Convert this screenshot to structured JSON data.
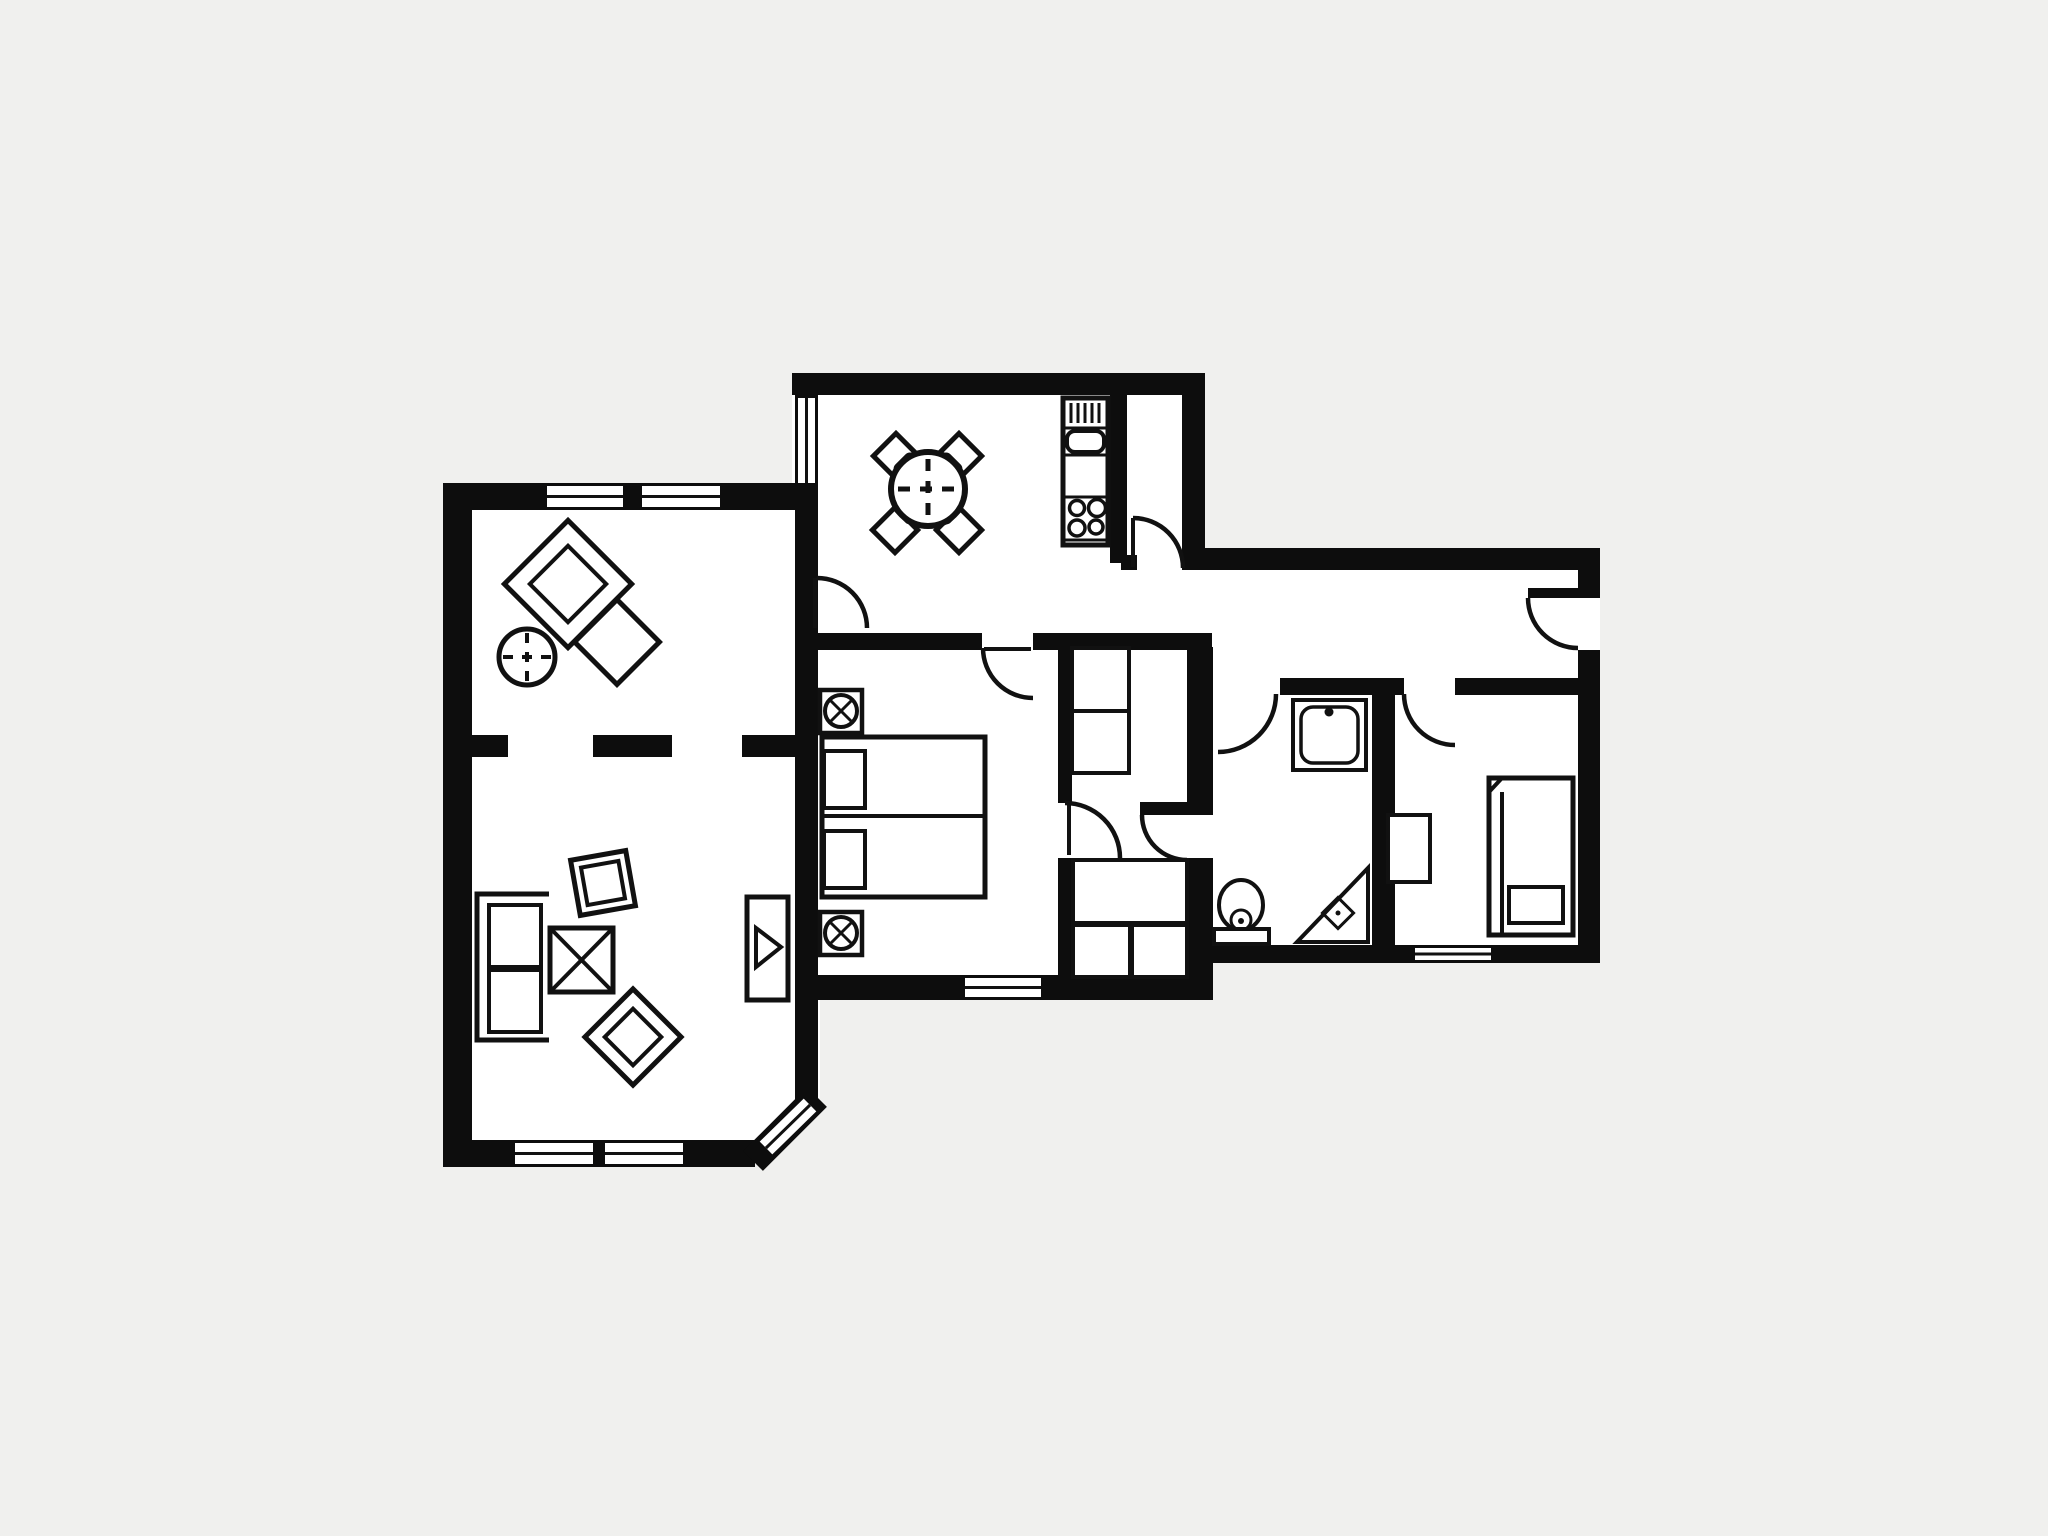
{
  "document": {
    "type": "architectural-floor-plan",
    "title": "Apartment floor plan",
    "visible_text": []
  },
  "colors": {
    "background": "#f0f0ee",
    "floor": "#ffffff",
    "wall": "#0d0d0d",
    "line": "#111111"
  },
  "rooms": [
    {
      "name": "living-room",
      "windows": 5,
      "features": [
        "dashed-room-divider",
        "chamfered-corner-window"
      ],
      "furniture": [
        "sofa",
        "coffee-table",
        "armchair",
        "lounge-chair",
        "tv-cabinet",
        "side-table",
        "dining-chair",
        "dining-chair"
      ]
    },
    {
      "name": "kitchen-dining",
      "windows": 1,
      "furniture": [
        "round-table",
        "chair",
        "chair",
        "chair",
        "chair",
        "kitchen-unit-sink-drainer-stove"
      ]
    },
    {
      "name": "pantry",
      "windows": 0,
      "furniture": []
    },
    {
      "name": "main-bedroom",
      "windows": 1,
      "furniture": [
        "double-bed",
        "nightstand-lamp",
        "nightstand-lamp"
      ]
    },
    {
      "name": "walk-through-closet",
      "windows": 0,
      "furniture": [
        "closet-upper",
        "closet-lower"
      ]
    },
    {
      "name": "bathroom",
      "windows": 0,
      "furniture": [
        "sink",
        "toilet",
        "corner-shower-with-drain"
      ]
    },
    {
      "name": "second-bedroom",
      "windows": 1,
      "furniture": [
        "single-bed",
        "wardrobe"
      ]
    },
    {
      "name": "entrance-hall",
      "windows": 0,
      "furniture": []
    }
  ],
  "doors": {
    "interior_swing_doors": 7,
    "entrance_doors": 1
  }
}
